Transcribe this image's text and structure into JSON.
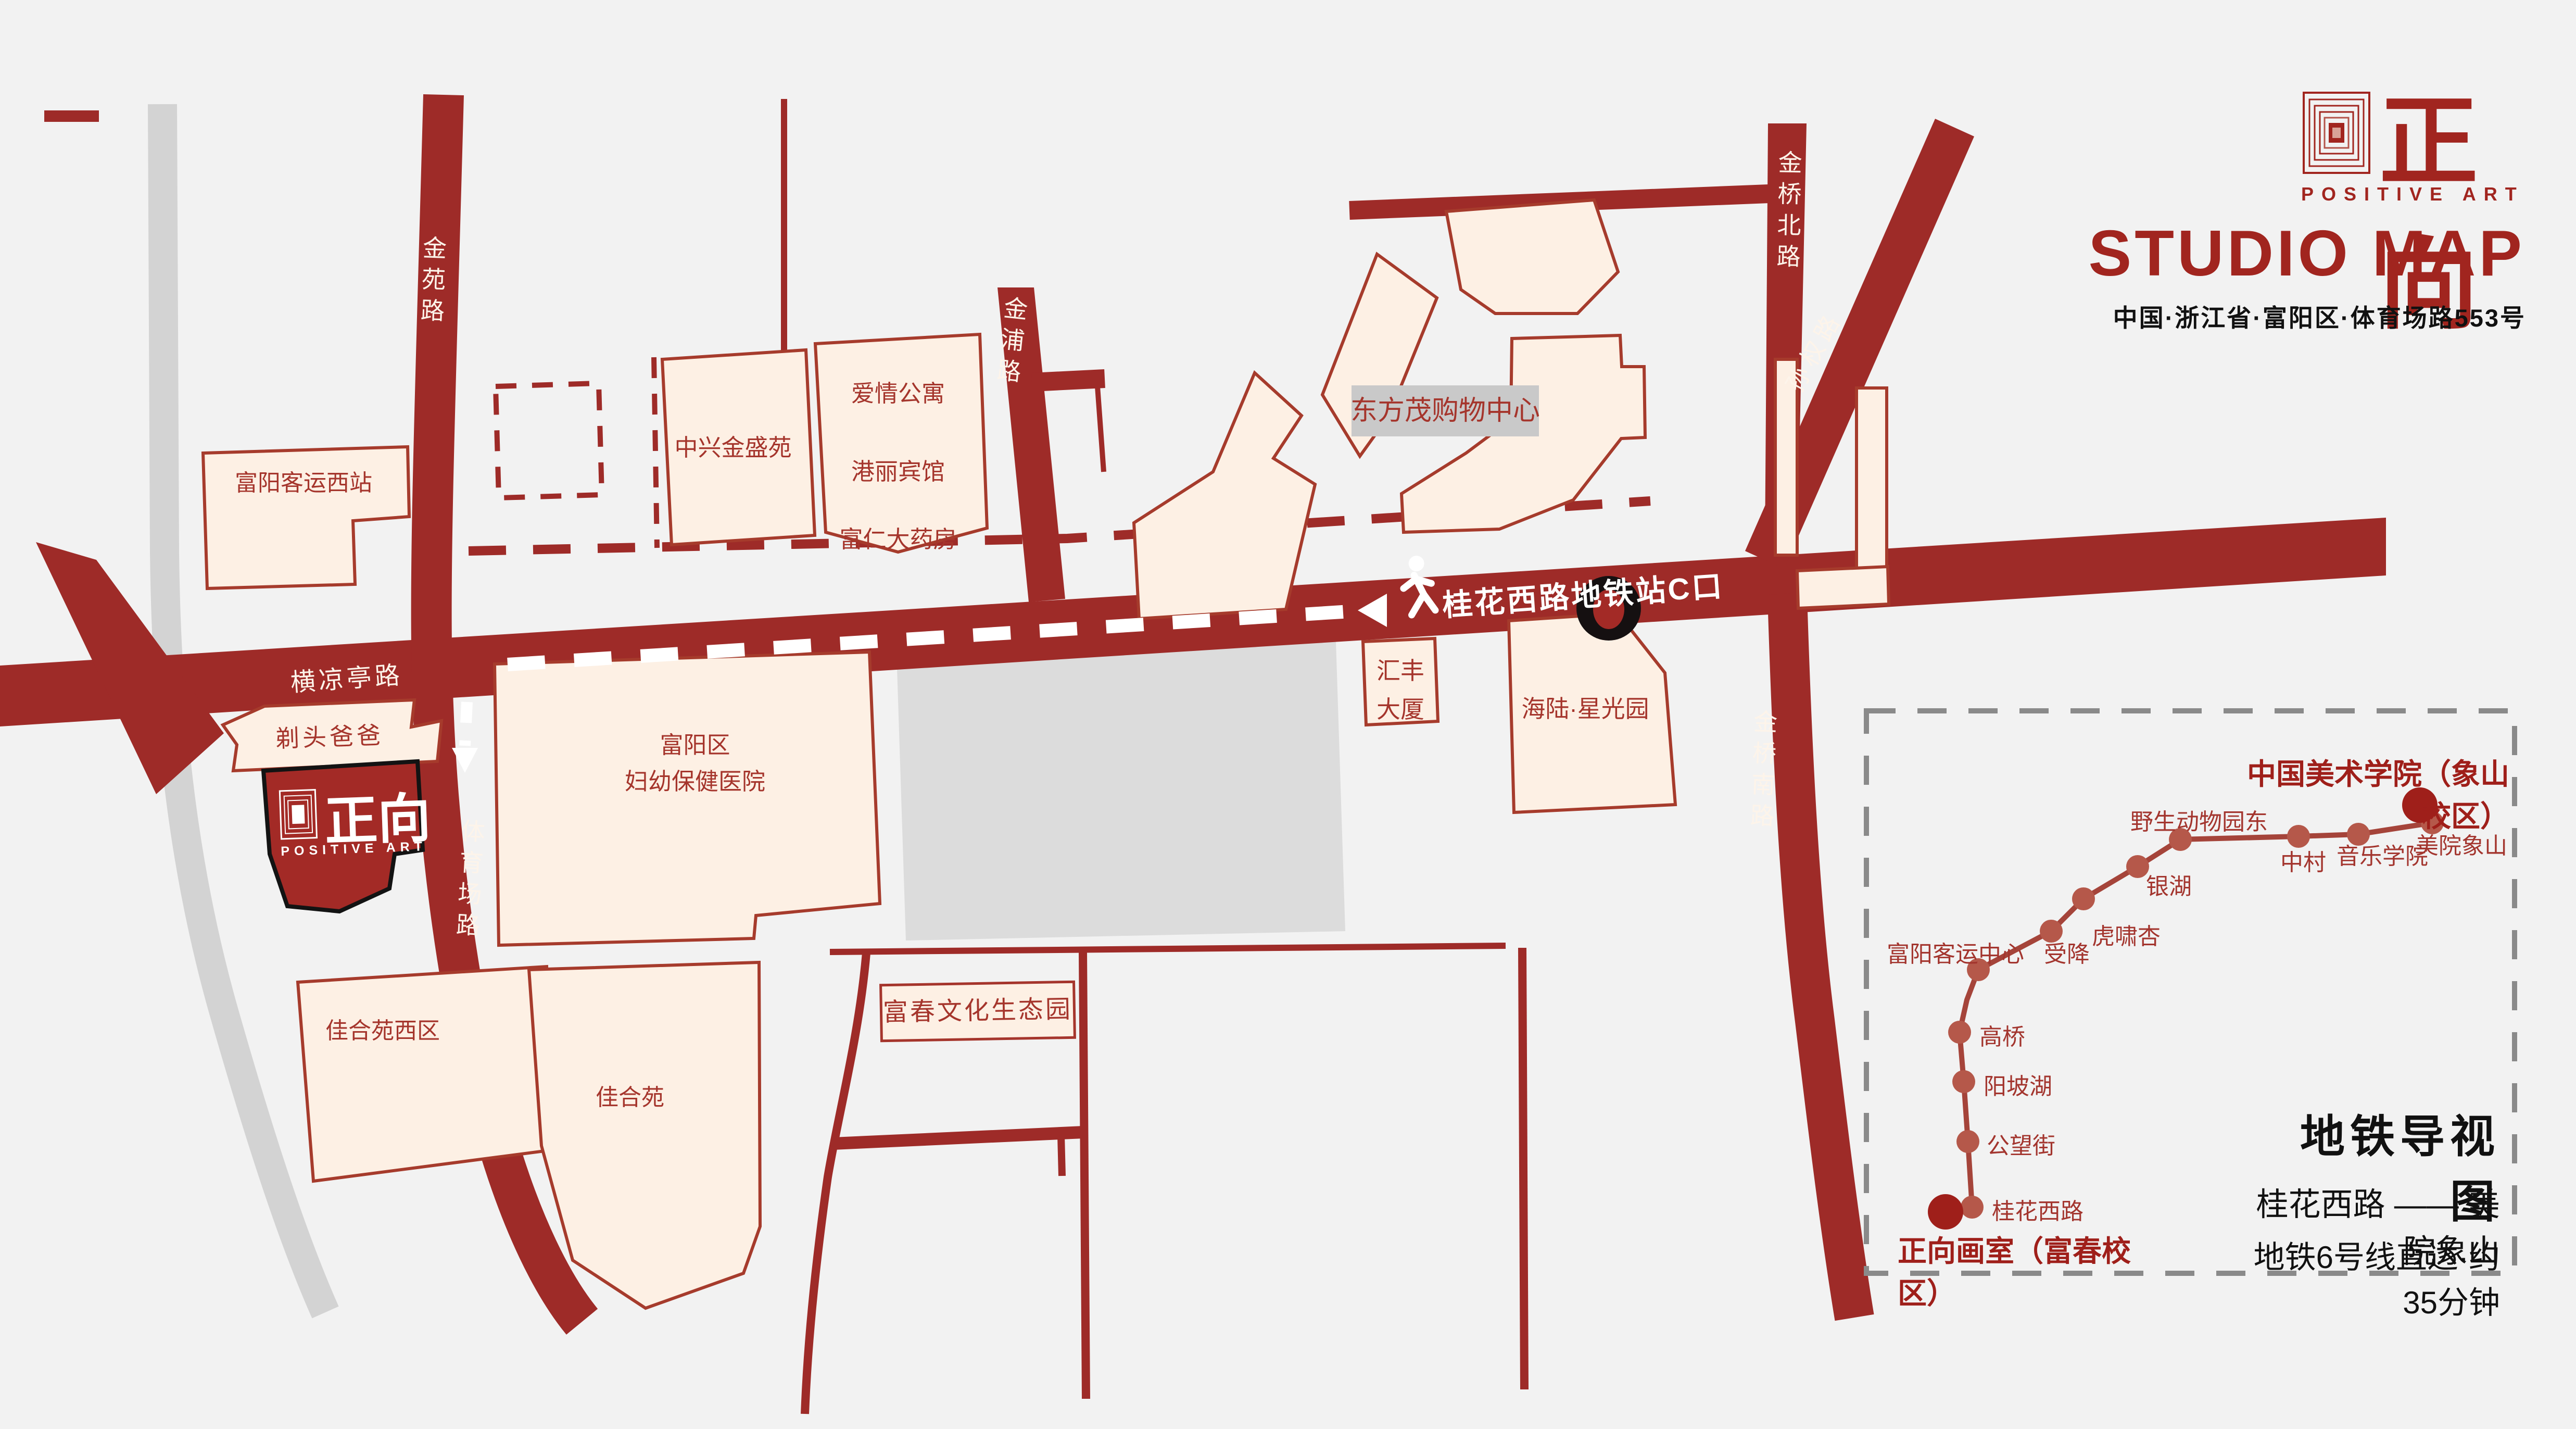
{
  "header": {
    "brand_cn": "正向",
    "brand_en": "POSITIVE ART",
    "title": "STUDIO MAP",
    "address": "中国·浙江省·富阳区·体育场路553号"
  },
  "map": {
    "roads": {
      "jinyuan": "金苑路",
      "jinpu": "金浦路",
      "jinqiao_north": "金桥北路",
      "jinqiao_south": "金桥南路",
      "sunquan": "孙权路",
      "hengliangting": "横凉亭路",
      "tiyuchang": "体育场路"
    },
    "banner": "桂花西路地铁站C口",
    "buildings": {
      "fuyang_west_station": "富阳客运西站",
      "zhongxing": "中兴金盛苑",
      "aiqing": "爱情公寓",
      "gangli": "港丽宾馆",
      "furen": "富仁大药房",
      "dongfangmao": "东方茂购物中心",
      "huifeng_l1": "汇丰",
      "huifeng_l2": "大厦",
      "hailu": "海陆·星光园",
      "hospital_l1": "富阳区",
      "hospital_l2": "妇幼保健医院",
      "titou": "剃头爸爸",
      "jiaheyuan_west": "佳合苑西区",
      "jiaheyuan": "佳合苑",
      "fuchun_park": "富春文化生态园"
    },
    "studio_logo": {
      "cn": "正向",
      "en": "POSITIVE ART"
    }
  },
  "metro": {
    "title": "地铁导视图",
    "route_line": "桂花西路 —— 美院象山",
    "route_note": "地铁6号线直达·约35分钟",
    "start": "正向画室（富春校区）",
    "end": "中国美术学院（象山校区）",
    "stations": [
      {
        "name": "桂花西路"
      },
      {
        "name": "公望街"
      },
      {
        "name": "阳坡湖"
      },
      {
        "name": "高桥"
      },
      {
        "name": "富阳客运中心"
      },
      {
        "name": "受降"
      },
      {
        "name": "虎啸杏"
      },
      {
        "name": "银湖"
      },
      {
        "name": "野生动物园东"
      },
      {
        "name": "中村"
      },
      {
        "name": "音乐学院"
      },
      {
        "name": "美院象山"
      }
    ]
  },
  "colors": {
    "background": "#f2f2f2",
    "road": "#9e2b28",
    "building_fill": "#fdf0e4",
    "building_stroke": "#a63b2c",
    "accent": "#a1251f",
    "river": "#d3d3d3",
    "plaza": "#dcdcdc",
    "marker_black": "#151011",
    "metro_dot": "#b5584a",
    "metro_line": "#a5443a"
  }
}
